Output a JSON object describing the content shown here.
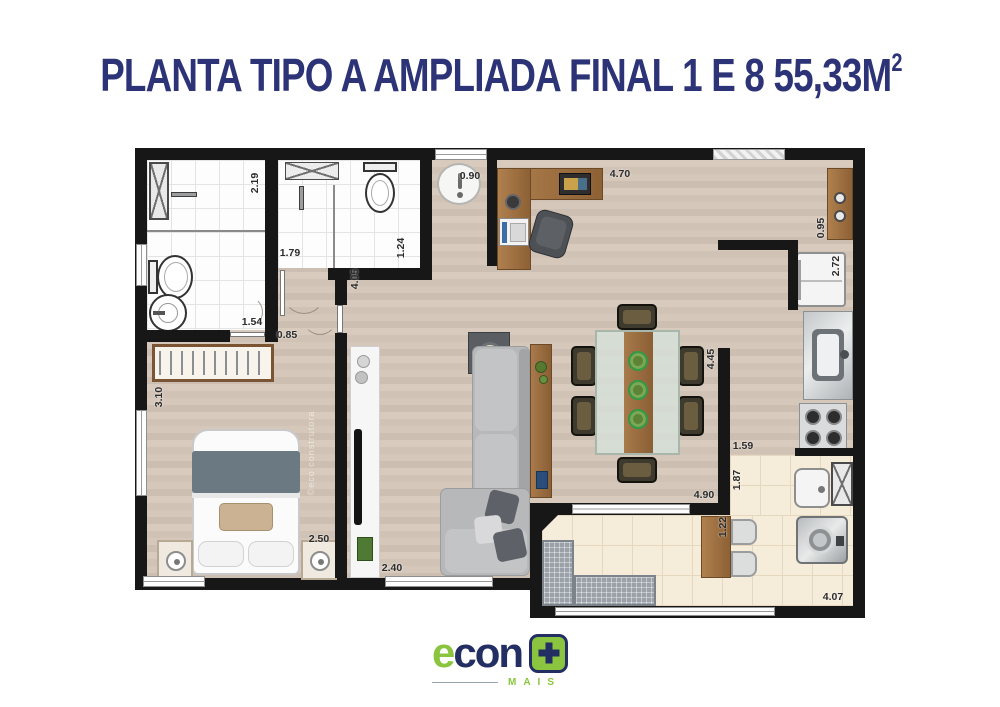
{
  "title": {
    "text": "PLANTA TIPO A AMPLIADA FINAL 1 E 8 55,33M",
    "sup": "2"
  },
  "watermark": {
    "text": "©eco construtora"
  },
  "floor_plan": {
    "dimensions": {
      "bath1_len": "2.19",
      "bath1_w": "1.54",
      "bath1_door": "0.85",
      "bath2_w": "1.79",
      "bath2_len": "1.24",
      "entry_door": "0.90",
      "living_w": "4.70",
      "sideboard": "0.95",
      "fridge_nook": "2.72",
      "kitchen_len": "4.45",
      "kitchen_w": "1.59",
      "service_len": "1.87",
      "service_w": "1.22",
      "living_len": "4.90",
      "balcony_len": "4.07",
      "hall_len": "4.05",
      "bedroom_len": "3.10",
      "bedroom_w": "2.50",
      "tv_wall": "2.40"
    }
  },
  "logo": {
    "econ_e": "e",
    "econ_rest": "con",
    "mais": "MAIS"
  },
  "colors": {
    "title_navy": "#2c3377",
    "logo_green": "#8bc53f",
    "logo_navy": "#232e63",
    "wall_black": "#171717",
    "wood_floor": "#d3c5b8",
    "tile_cream": "#f6ecda"
  }
}
